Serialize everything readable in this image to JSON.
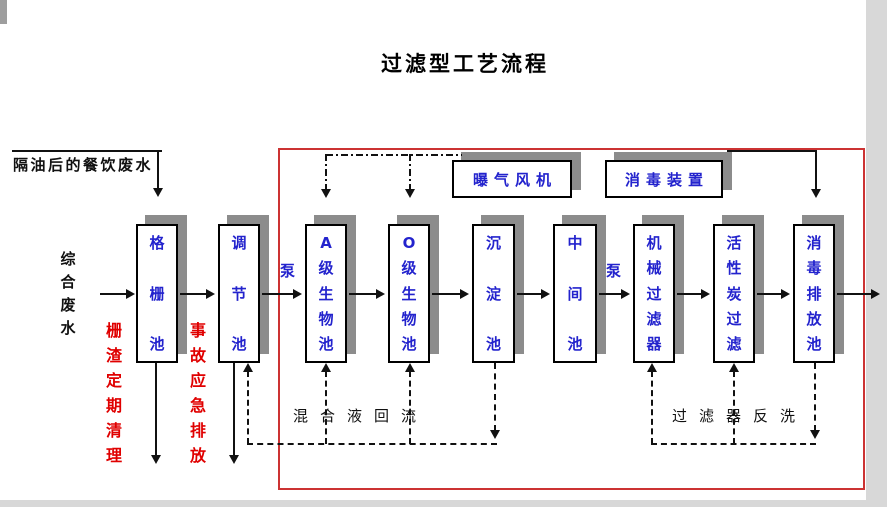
{
  "title": "过滤型工艺流程",
  "diagram": {
    "influent_top_label": "隔油后的餐饮废水",
    "influent_left_label": "综合废水",
    "pump_label_1": "泵",
    "pump_label_2": "泵",
    "tanks": [
      {
        "label": "格栅池"
      },
      {
        "label": "调节池"
      },
      {
        "label": "A级生物池"
      },
      {
        "label": "O级生物池"
      },
      {
        "label": "沉淀池"
      },
      {
        "label": "中间池"
      },
      {
        "label": "机械过滤器"
      },
      {
        "label": "活性炭过滤"
      },
      {
        "label": "消毒排放池"
      }
    ],
    "equipment": [
      {
        "label": "曝气风机"
      },
      {
        "label": "消毒装置"
      }
    ],
    "side_notes": [
      {
        "label": "栅渣定期清理"
      },
      {
        "label": "事故应急排放"
      }
    ],
    "flow_annotations": [
      {
        "label": "混合液回流"
      },
      {
        "label": "过滤器反洗"
      }
    ],
    "colors": {
      "tank_text": "#2323cd",
      "note_text": "#e00000",
      "boundary": "#cc3333",
      "shadow": "#8c8c8c",
      "line": "#111111"
    }
  }
}
